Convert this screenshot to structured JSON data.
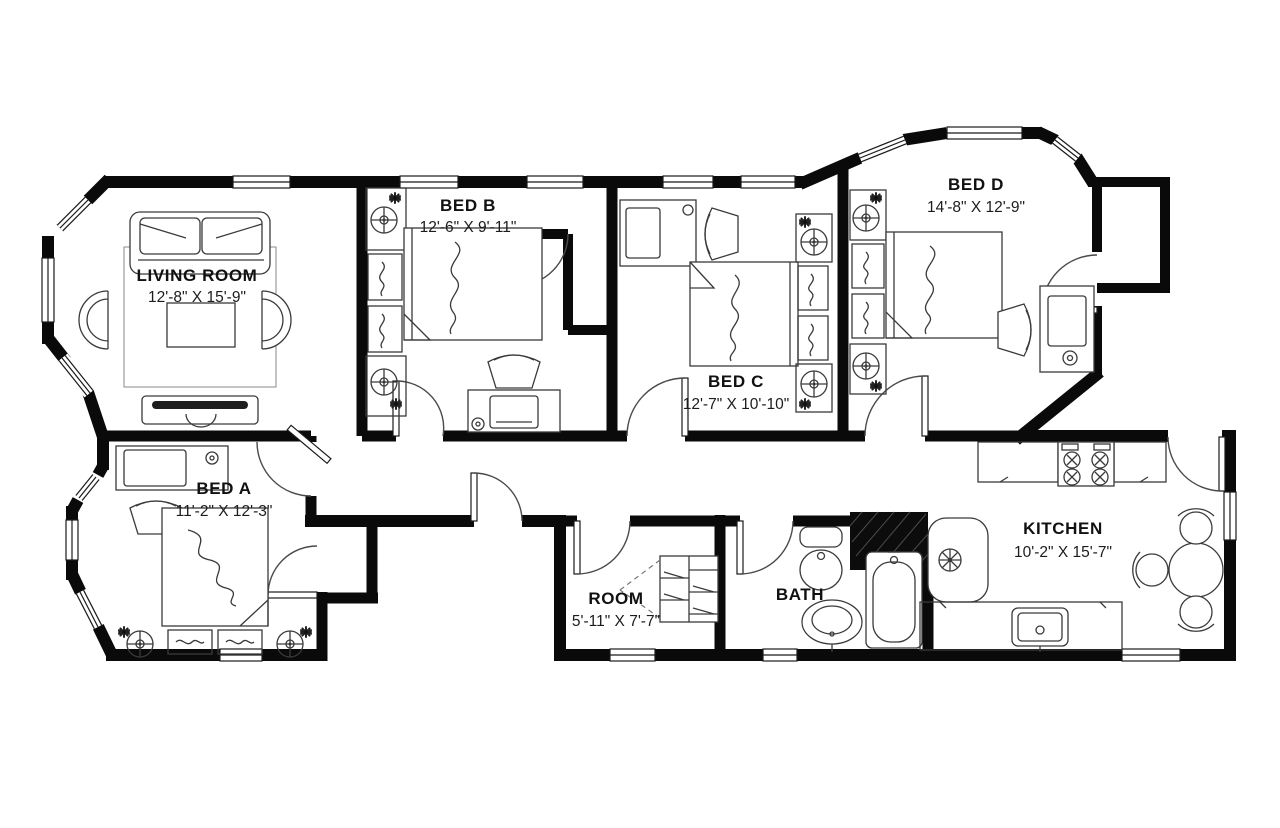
{
  "plan": {
    "title": "apartment-floor-plan",
    "wall_color": "#0a0a0a",
    "background": "#ffffff",
    "rooms": {
      "living": {
        "name": "LIVING ROOM",
        "dims": "12'-8\" X 15'-9\""
      },
      "bed_b": {
        "name": "BED B",
        "dims": "12'-6\" X 9'-11\""
      },
      "bed_c": {
        "name": "BED C",
        "dims": "12'-7\" X 10'-10\""
      },
      "bed_d": {
        "name": "BED D",
        "dims": "14'-8\" X 12'-9\""
      },
      "bed_a": {
        "name": "BED A",
        "dims": "11'-2\" X 12'-3\""
      },
      "room": {
        "name": "ROOM",
        "dims": "5'-11\" X 7'-7\""
      },
      "bath": {
        "name": "BATH",
        "dims": ""
      },
      "kitchen": {
        "name": "KITCHEN",
        "dims": "10'-2\" X 15'-7\""
      }
    }
  }
}
